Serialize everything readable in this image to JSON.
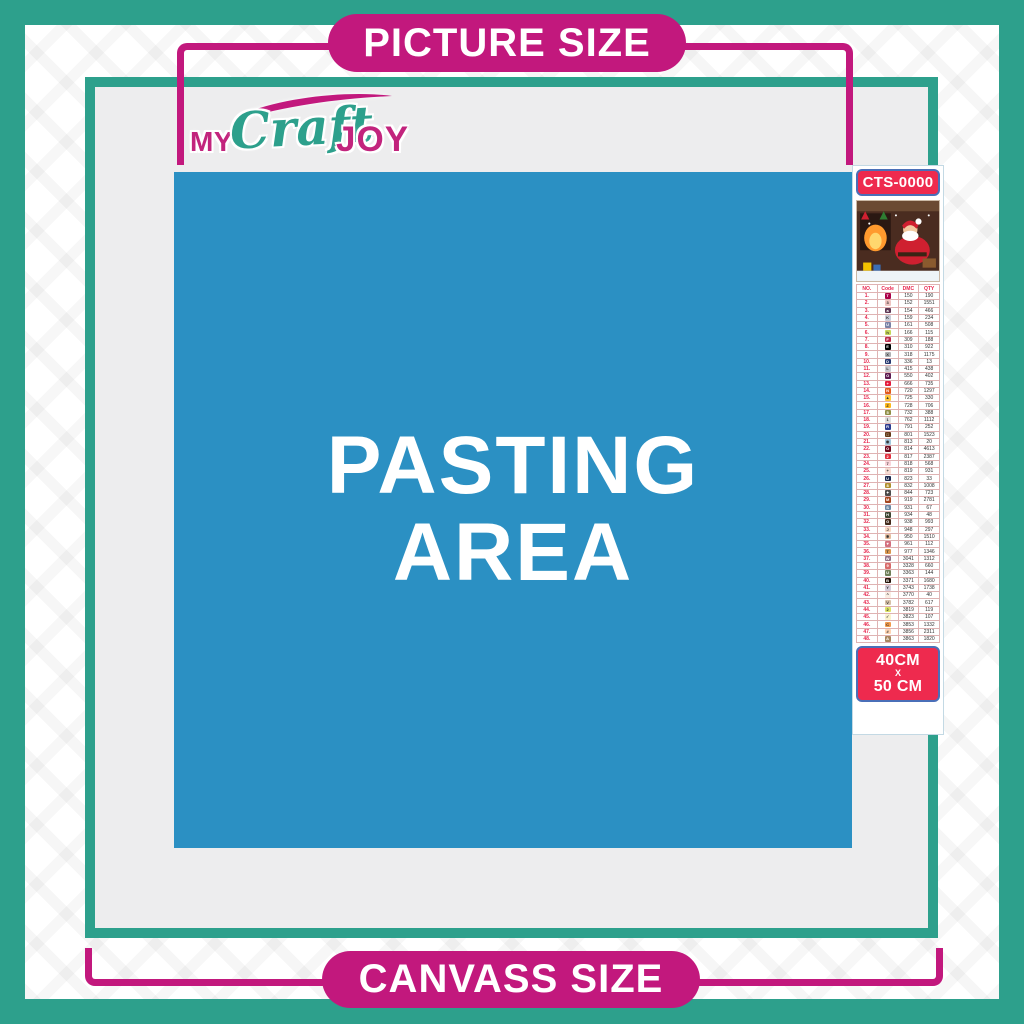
{
  "banners": {
    "top": "PICTURE SIZE",
    "bottom": "CANVASS SIZE"
  },
  "logo": {
    "part1": "MY",
    "part2": "Craft",
    "part3": "JOY",
    "swoosh": "brush-swoosh"
  },
  "pasting_area": {
    "line1": "PASTING",
    "line2": "AREA"
  },
  "colors": {
    "teal": "#2da08c",
    "magenta": "#c2187d",
    "blue": "#2b90c3",
    "badge_red": "#ee2a4e",
    "badge_border_blue": "#4a6fb8",
    "panel_gray": "#ededee",
    "table_red": "#e8254d"
  },
  "sidebar": {
    "sku": "CTS-0000",
    "thumbnail": "santa-fireplace-christmas-scene",
    "size": {
      "line1": "40CM",
      "sep": "X",
      "line2": "50 CM"
    },
    "table": {
      "headers": [
        "NO.",
        "Code",
        "DMC",
        "QTY"
      ],
      "rows": [
        {
          "no": "1.",
          "sym": "T",
          "bg": "#ab0249",
          "fg": "#fff",
          "dmc": "150",
          "qty": "190"
        },
        {
          "no": "2.",
          "sym": "3",
          "bg": "#eec4c1",
          "fg": "#333",
          "dmc": "152",
          "qty": "1551"
        },
        {
          "no": "3.",
          "sym": "a",
          "bg": "#5d3754",
          "fg": "#fff",
          "dmc": "154",
          "qty": "466"
        },
        {
          "no": "4.",
          "sym": "K",
          "bg": "#c9ccd8",
          "fg": "#333",
          "dmc": "159",
          "qty": "234"
        },
        {
          "no": "5.",
          "sym": "U",
          "bg": "#7a82a6",
          "fg": "#fff",
          "dmc": "161",
          "qty": "508"
        },
        {
          "no": "6.",
          "sym": "h",
          "bg": "#c5d75a",
          "fg": "#333",
          "dmc": "166",
          "qty": "115"
        },
        {
          "no": "7.",
          "sym": "F",
          "bg": "#bb2d4e",
          "fg": "#fff",
          "dmc": "309",
          "qty": "188"
        },
        {
          "no": "8.",
          "sym": "E",
          "bg": "#000000",
          "fg": "#fff",
          "dmc": "310",
          "qty": "922"
        },
        {
          "no": "9.",
          "sym": "X",
          "bg": "#b0b0b3",
          "fg": "#333",
          "dmc": "318",
          "qty": "1175"
        },
        {
          "no": "10.",
          "sym": "D",
          "bg": "#27386f",
          "fg": "#fff",
          "dmc": "336",
          "qty": "13"
        },
        {
          "no": "11.",
          "sym": "L",
          "bg": "#c9c9cf",
          "fg": "#333",
          "dmc": "415",
          "qty": "438"
        },
        {
          "no": "12.",
          "sym": "O",
          "bg": "#5e1a50",
          "fg": "#fff",
          "dmc": "550",
          "qty": "402"
        },
        {
          "no": "13.",
          "sym": "+",
          "bg": "#e31c3d",
          "fg": "#fff",
          "dmc": "666",
          "qty": "735"
        },
        {
          "no": "14.",
          "sym": "N",
          "bg": "#e2591c",
          "fg": "#fff",
          "dmc": "720",
          "qty": "1297"
        },
        {
          "no": "15.",
          "sym": "▲",
          "bg": "#ffc73f",
          "fg": "#333",
          "dmc": "725",
          "qty": "330"
        },
        {
          "no": "16.",
          "sym": "Z",
          "bg": "#fdb71c",
          "fg": "#333",
          "dmc": "728",
          "qty": "706"
        },
        {
          "no": "17.",
          "sym": "5",
          "bg": "#8f8d45",
          "fg": "#fff",
          "dmc": "732",
          "qty": "388"
        },
        {
          "no": "18.",
          "sym": "1",
          "bg": "#dedede",
          "fg": "#333",
          "dmc": "762",
          "qty": "1112"
        },
        {
          "no": "19.",
          "sym": "R",
          "bg": "#2e3c8e",
          "fg": "#fff",
          "dmc": "791",
          "qty": "252"
        },
        {
          "no": "20.",
          "sym": "□",
          "bg": "#653a18",
          "fg": "#fff",
          "dmc": "801",
          "qty": "1523"
        },
        {
          "no": "21.",
          "sym": "◉",
          "bg": "#a3c8dd",
          "fg": "#333",
          "dmc": "813",
          "qty": "20"
        },
        {
          "no": "22.",
          "sym": "O",
          "bg": "#6e0a1e",
          "fg": "#fff",
          "dmc": "814",
          "qty": "4613"
        },
        {
          "no": "23.",
          "sym": "2",
          "bg": "#e22f3f",
          "fg": "#fff",
          "dmc": "817",
          "qty": "2387"
        },
        {
          "no": "24.",
          "sym": "7",
          "bg": "#f9d3d9",
          "fg": "#333",
          "dmc": "818",
          "qty": "568"
        },
        {
          "no": "25.",
          "sym": "+",
          "bg": "#f6dbd2",
          "fg": "#333",
          "dmc": "819",
          "qty": "931"
        },
        {
          "no": "26.",
          "sym": "U",
          "bg": "#1d2a4f",
          "fg": "#fff",
          "dmc": "823",
          "qty": "33"
        },
        {
          "no": "27.",
          "sym": "8",
          "bg": "#b08e2e",
          "fg": "#fff",
          "dmc": "832",
          "qty": "1008"
        },
        {
          "no": "28.",
          "sym": "✦",
          "bg": "#4c4c4c",
          "fg": "#fff",
          "dmc": "844",
          "qty": "723"
        },
        {
          "no": "29.",
          "sym": "M",
          "bg": "#a4461f",
          "fg": "#fff",
          "dmc": "919",
          "qty": "2781"
        },
        {
          "no": "30.",
          "sym": "S",
          "bg": "#6c88a5",
          "fg": "#fff",
          "dmc": "931",
          "qty": "67"
        },
        {
          "no": "31.",
          "sym": "H",
          "bg": "#3f4633",
          "fg": "#fff",
          "dmc": "934",
          "qty": "48"
        },
        {
          "no": "32.",
          "sym": "G",
          "bg": "#42291a",
          "fg": "#fff",
          "dmc": "938",
          "qty": "993"
        },
        {
          "no": "33.",
          "sym": "J",
          "bg": "#f7d8c4",
          "fg": "#333",
          "dmc": "948",
          "qty": "297"
        },
        {
          "no": "34.",
          "sym": "✱",
          "bg": "#e5bd9e",
          "fg": "#333",
          "dmc": "950",
          "qty": "1510"
        },
        {
          "no": "35.",
          "sym": "♥",
          "bg": "#d3707f",
          "fg": "#fff",
          "dmc": "961",
          "qty": "112"
        },
        {
          "no": "36.",
          "sym": "T",
          "bg": "#d9964f",
          "fg": "#333",
          "dmc": "977",
          "qty": "1346"
        },
        {
          "no": "37.",
          "sym": "W",
          "bg": "#8f7086",
          "fg": "#fff",
          "dmc": "3041",
          "qty": "1312"
        },
        {
          "no": "38.",
          "sym": "9",
          "bg": "#d86a6a",
          "fg": "#fff",
          "dmc": "3328",
          "qty": "660"
        },
        {
          "no": "39.",
          "sym": "U",
          "bg": "#71805a",
          "fg": "#fff",
          "dmc": "3363",
          "qty": "144"
        },
        {
          "no": "40.",
          "sym": "B",
          "bg": "#241309",
          "fg": "#fff",
          "dmc": "3371",
          "qty": "1680"
        },
        {
          "no": "41.",
          "sym": "Y",
          "bg": "#d4cbd8",
          "fg": "#333",
          "dmc": "3743",
          "qty": "1738"
        },
        {
          "no": "42.",
          "sym": "^",
          "bg": "#f9ece2",
          "fg": "#333",
          "dmc": "3770",
          "qty": "40"
        },
        {
          "no": "43.",
          "sym": "V",
          "bg": "#d6c0a8",
          "fg": "#333",
          "dmc": "3782",
          "qty": "617"
        },
        {
          "no": "44.",
          "sym": "2",
          "bg": "#dce267",
          "fg": "#333",
          "dmc": "3819",
          "qty": "119"
        },
        {
          "no": "45.",
          "sym": "✓",
          "bg": "#fbf2cd",
          "fg": "#333",
          "dmc": "3823",
          "qty": "107"
        },
        {
          "no": "46.",
          "sym": "C",
          "bg": "#f19a4d",
          "fg": "#333",
          "dmc": "3853",
          "qty": "1332"
        },
        {
          "no": "47.",
          "sym": "#",
          "bg": "#fed3b3",
          "fg": "#333",
          "dmc": "3856",
          "qty": "2311"
        },
        {
          "no": "48.",
          "sym": "A",
          "bg": "#a8855e",
          "fg": "#fff",
          "dmc": "3863",
          "qty": "1820"
        }
      ]
    }
  }
}
